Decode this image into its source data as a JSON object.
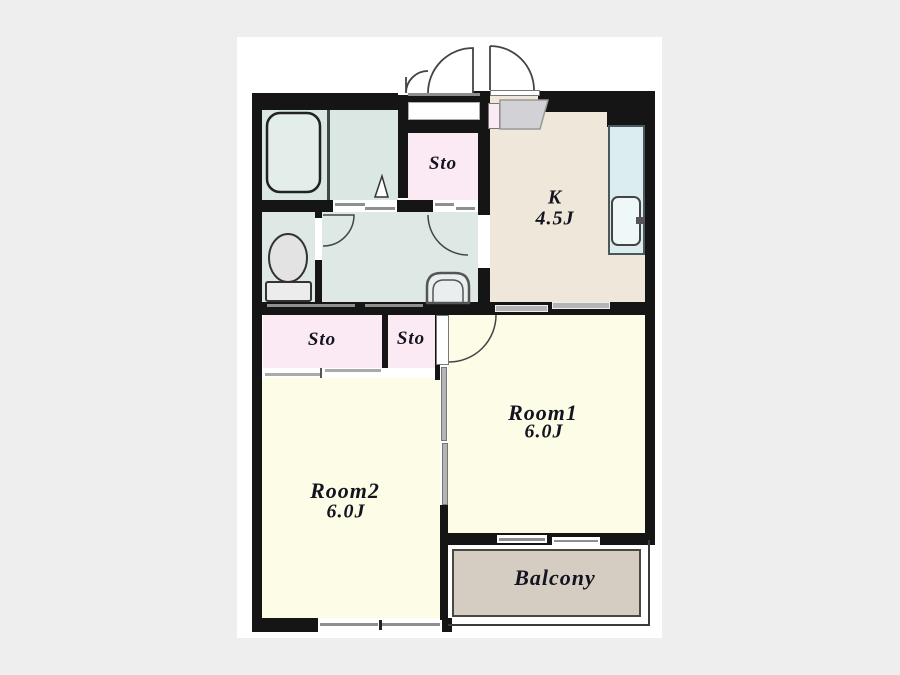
{
  "palette": {
    "bg": "#eeeeee",
    "paper": "#ffffff",
    "wall": "#151515",
    "wet": "#dbe7e3",
    "wet2": "#dee9e6",
    "pink": "#fbeaf3",
    "kitchen": "#efe7da",
    "cream": "#fdfce6",
    "balcony": "#d5ccc2"
  },
  "plan": {
    "storage_top": "Sto",
    "storage_left": "Sto",
    "storage_right": "Sto",
    "kitchen": {
      "name": "K",
      "size": "4.5J"
    },
    "room1": {
      "name": "Room1",
      "size": "6.0J"
    },
    "room2": {
      "name": "Room2",
      "size": "6.0J"
    },
    "balcony": "Balcony"
  },
  "fixtures": {
    "bathtub": "bathtub",
    "toilet": "toilet",
    "washbasin": "washbasin",
    "kitchen_sink": "kitchen-sink",
    "entrance_doors": "double-entrance-door-swings"
  }
}
